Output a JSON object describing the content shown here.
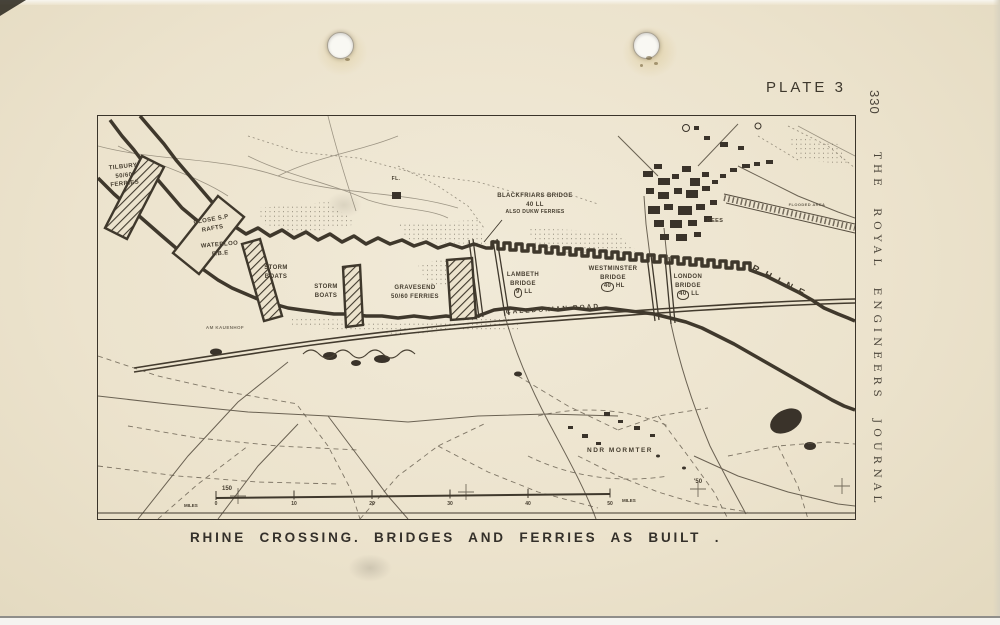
{
  "page": {
    "plate_label": "PLATE 3",
    "page_number": "330",
    "journal_title": "THE ROYAL ENGINEERS JOURNAL",
    "caption": {
      "left": "RHINE CROSSING.",
      "right": "BRIDGES AND FERRIES AS BUILT ."
    }
  },
  "map": {
    "labels": {
      "river": "RHINE",
      "railway": "CALEDONIAN ROAD",
      "town": "REES",
      "village": "NDR MORMTER",
      "farm": "AM KAUENHOF",
      "flooded_area": "FLOODED AREA",
      "airstrip": "FL."
    },
    "crossings": [
      {
        "name": "TILBURY",
        "detail": "50/60 FERRIES"
      },
      {
        "name": "CLOSE S.P RAFTS",
        "detail": ""
      },
      {
        "name": "WATERLOO",
        "detail": "F.B.E"
      },
      {
        "name": "STORM BOATS",
        "detail": ""
      },
      {
        "name": "STORM BOATS",
        "detail": ""
      },
      {
        "name": "GRAVESEND",
        "detail": "50/60 FERRIES"
      },
      {
        "name": "BLACKFRIARS BRIDGE",
        "class_num": "40",
        "class_level": "LL",
        "note": "ALSO DUKW FERRIES"
      },
      {
        "name": "LAMBETH BRIDGE",
        "class_num": "9",
        "class_level": "LL"
      },
      {
        "name": "WESTMINSTER BRIDGE",
        "class_num": "40",
        "class_level": "HL"
      },
      {
        "name": "LONDON BRIDGE",
        "class_num": "40",
        "class_level": "LL"
      }
    ],
    "scale": {
      "unit_left": "MILES",
      "ticks": [
        "0",
        "10",
        "20",
        "30",
        "40",
        "50"
      ],
      "unit_right": "MILES",
      "grid_ref_left": "150",
      "grid_ref_right": "'50"
    }
  },
  "colors": {
    "paper": "#ece3cd",
    "ink": "#3f382c",
    "caption_ink": "#34302a"
  }
}
